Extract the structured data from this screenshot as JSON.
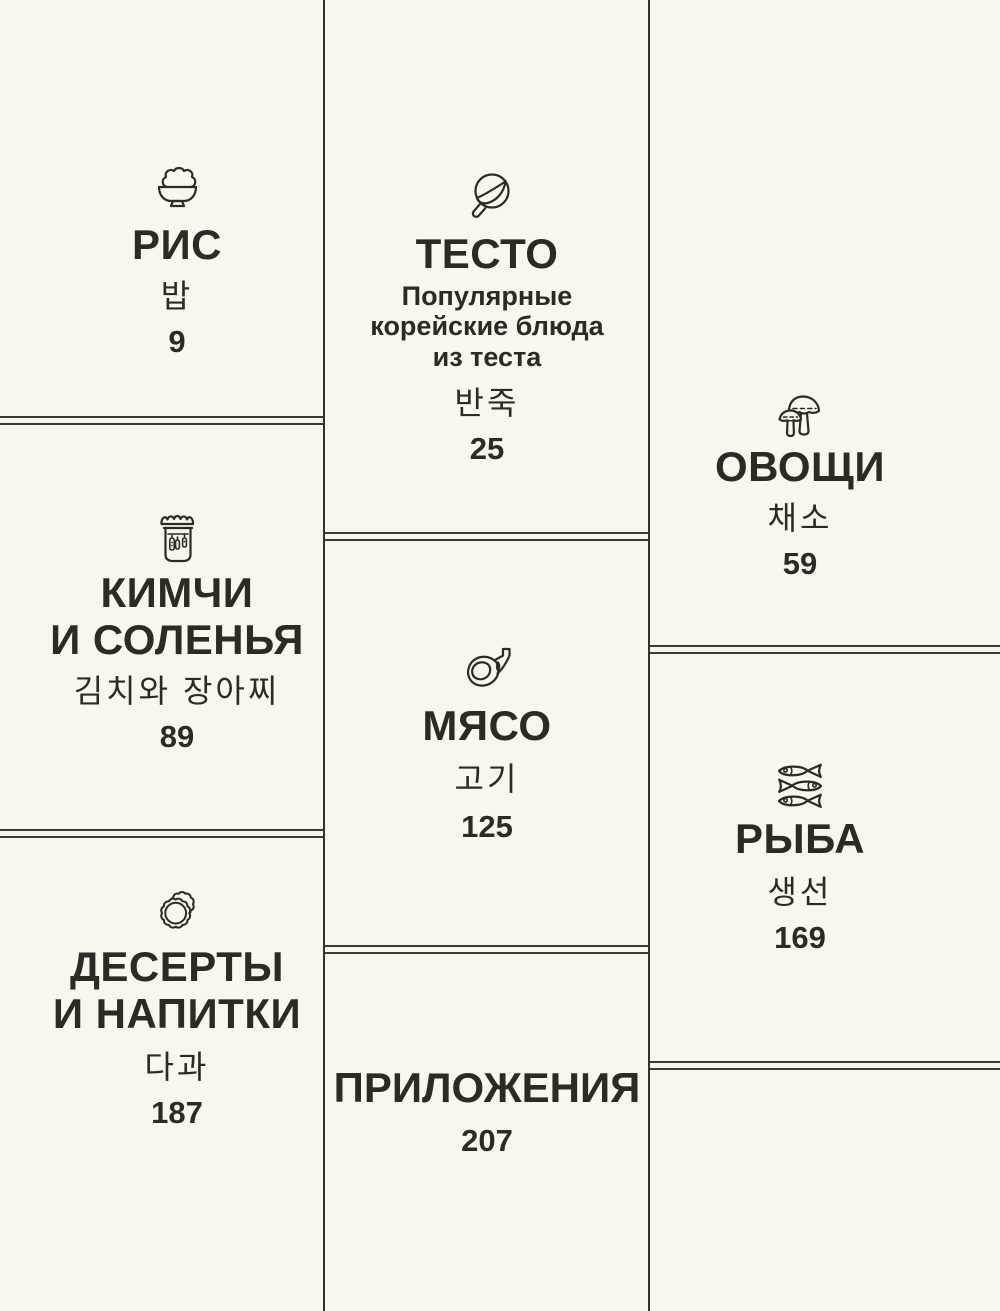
{
  "page": {
    "background_color": "#fbf6ed",
    "ink_color": "#2d2a26",
    "divider_color": "#3c3834",
    "description": "Cookbook table of contents grid"
  },
  "sections": [
    {
      "id": "rice",
      "icon": "rice-bowl-icon",
      "title_lines": [
        "РИС"
      ],
      "korean": "밥",
      "page": "9"
    },
    {
      "id": "dough",
      "icon": "frying-pan-icon",
      "title_lines": [
        "ТЕСТО"
      ],
      "subtitle_lines": [
        "Популярные",
        "корейские блюда",
        "из теста"
      ],
      "korean": "반죽",
      "page": "25"
    },
    {
      "id": "vegetables",
      "icon": "mushrooms-icon",
      "title_lines": [
        "ОВОЩИ"
      ],
      "korean": "채소",
      "page": "59"
    },
    {
      "id": "kimchi",
      "icon": "pickle-jar-icon",
      "title_lines": [
        "КИМЧИ",
        "И СОЛЕНЬЯ"
      ],
      "korean": "김치와 장아찌",
      "page": "89"
    },
    {
      "id": "meat",
      "icon": "meat-icon",
      "title_lines": [
        "МЯСО"
      ],
      "korean": "고기",
      "page": "125"
    },
    {
      "id": "fish",
      "icon": "fish-stack-icon",
      "title_lines": [
        "РЫБА"
      ],
      "korean": "생선",
      "page": "169"
    },
    {
      "id": "desserts",
      "icon": "cookies-icon",
      "title_lines": [
        "ДЕСЕРТЫ",
        "И НАПИТКИ"
      ],
      "korean": "다과",
      "page": "187"
    },
    {
      "id": "appendix",
      "icon": "",
      "title_lines": [
        "ПРИЛОЖЕНИЯ"
      ],
      "korean": "",
      "page": "207"
    }
  ]
}
